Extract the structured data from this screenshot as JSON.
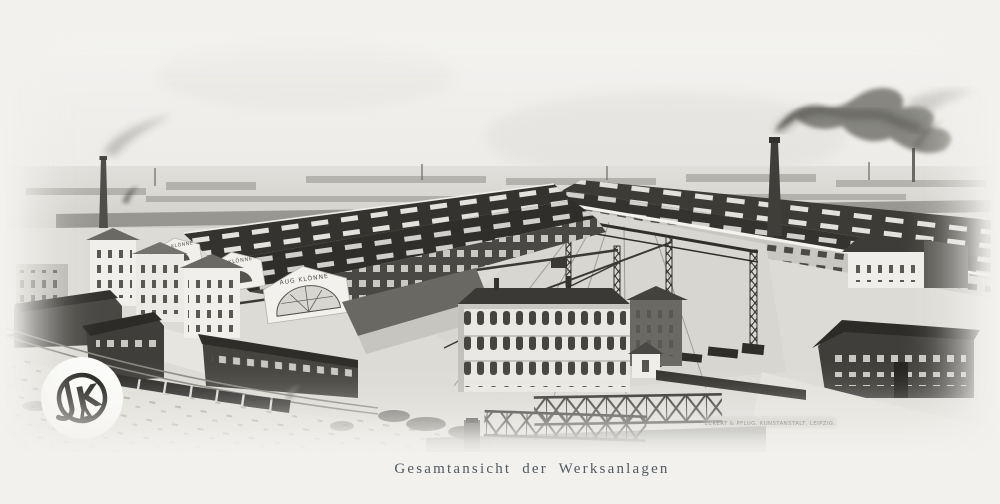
{
  "artwork": {
    "caption": "Gesamtansicht der Werksanlagen",
    "printer_credit": "ECKERT & PFLUG, KUNSTANSTALT, LEIPZIG."
  },
  "signs": {
    "gable_small_1": "AUG KLÖNNE",
    "gable_small_2": "AUG KLÖNNE",
    "gable_large": "AUG KLÖNNE"
  },
  "logo": {
    "letter_j": "J",
    "letter_k": "K",
    "letter_a": "A"
  },
  "colors": {
    "paper": "#f1f0ed",
    "ink_dark": "#2e2d2a",
    "roof_dark": "#34332f",
    "building_white": "#f0efeb",
    "smoke": "#4a4946",
    "caption": "#4f5a62"
  }
}
